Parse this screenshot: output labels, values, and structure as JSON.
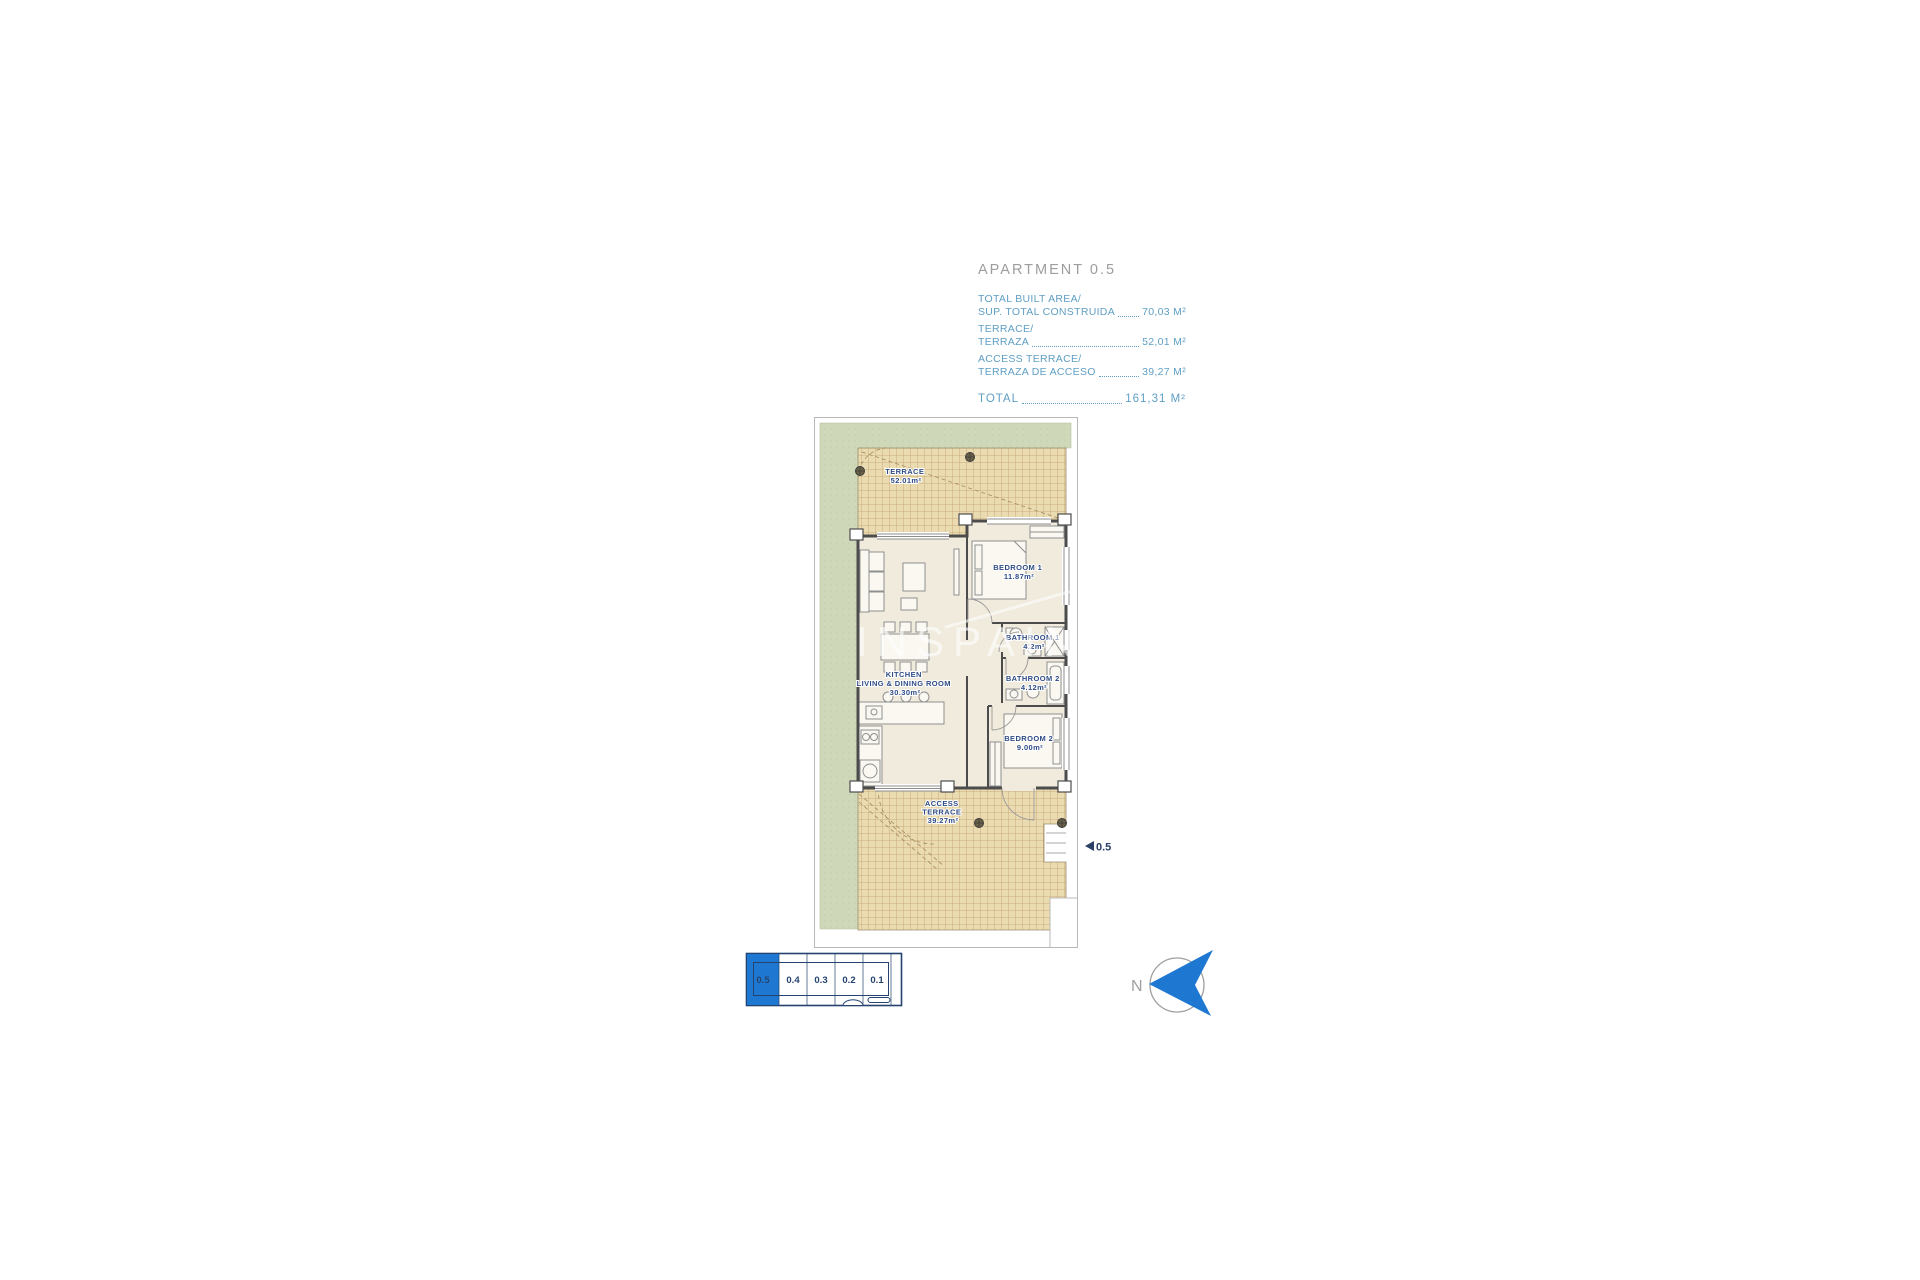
{
  "header": {
    "title": "APARTMENT 0.5"
  },
  "summary": {
    "rows": [
      {
        "label_line1": "TOTAL BUILT AREA/",
        "label_line2": "SUP. TOTAL CONSTRUIDA",
        "value": "70,03 M²"
      },
      {
        "label_line1": "TERRACE/",
        "label_line2": "TERRAZA",
        "value": "52,01 M²"
      },
      {
        "label_line1": "ACCESS TERRACE/",
        "label_line2": "TERRAZA DE ACCESO",
        "value": "39,27 M²"
      }
    ],
    "total_label": "TOTAL",
    "total_value": "161,31 M²"
  },
  "floorplan": {
    "terrace": {
      "name": "TERRACE",
      "area": "52.01m²"
    },
    "bedroom1": {
      "name": "BEDROOM  1",
      "area": "11.87m²"
    },
    "bathroom1": {
      "name": "BATHROOM  1",
      "area": "4.2m²"
    },
    "bathroom2": {
      "name": "BATHROOM  2",
      "area": "4.12m²"
    },
    "kitchen": {
      "name": "KITCHEN",
      "name2": "LIVING  &  DINING  ROOM",
      "area": "30.30m²"
    },
    "bedroom2": {
      "name": "BEDROOM  2",
      "area": "9.00m²"
    },
    "access_terrace": {
      "name1": "ACCESS",
      "name2": "TERRACE",
      "area": "39.27m²"
    },
    "unit_marker": "0.5"
  },
  "keyplan": {
    "units": [
      "0.5",
      "0.4",
      "0.3",
      "0.2",
      "0.1"
    ],
    "highlighted_unit": "0.5"
  },
  "compass": {
    "north_label": "N"
  },
  "watermark": {
    "text": "INSPAIN"
  },
  "colors": {
    "accent_blue": "#5F9FC5",
    "highlight_blue": "#1E78D2",
    "label_navy": "#2F4C87",
    "keyplan_navy": "#24436F",
    "lawn_green": "#CFD9BA",
    "tile_tan": "#EBDBB1",
    "floor_cream": "#F0EBDD",
    "wall_gray": "#4C4C4C",
    "title_gray": "#9D9D9D"
  }
}
